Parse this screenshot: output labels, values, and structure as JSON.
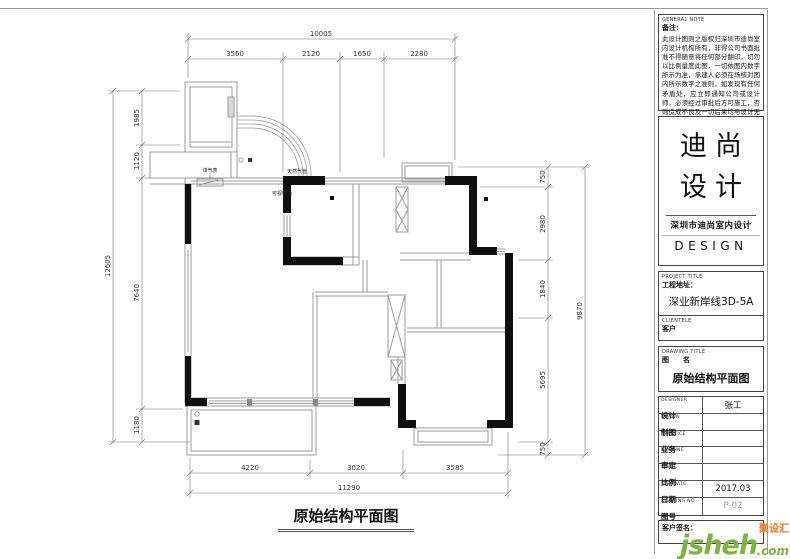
{
  "plan": {
    "title": "原始结构平面图",
    "labels": {
      "gas_meter": "煤气表",
      "gas_pipe": "天然气管",
      "intercom": "可视电话"
    },
    "dims": {
      "top": {
        "overall": "10005",
        "segs": [
          "3560",
          "2120",
          "1650",
          "2280"
        ]
      },
      "left": {
        "overall": "12605",
        "segs": [
          "1985",
          "1120",
          "7640",
          "1180"
        ]
      },
      "right": {
        "overall": "9870",
        "segs": [
          "750",
          "2980",
          "1840",
          "5695",
          "750"
        ]
      },
      "bottom": {
        "overall": "11290",
        "segs": [
          "4220",
          "3020",
          "3585"
        ]
      }
    }
  },
  "title_block": {
    "general_note": {
      "label_en": "GENERAL NOTE",
      "label_cn": "备注:",
      "text": "此设计图则之版权归深圳市迪尚室内设计机构所有，非得公司书面批准不得随意将任何部分翻印，切勿以比例量度此图，一切依图内数字所示为准，承建人必须在场核对图内所示数字之准则，如发现有任何矛盾处，应立即通知公司或设计师，必须经过审批后方可施工，否则造成不良及一切后果均与设计无关。"
    },
    "logo": {
      "line1": "迪尚",
      "line2": "设计",
      "subtitle": "深圳市迪尚室内设计",
      "en": "DESIGN"
    },
    "project": {
      "label_en": "PROJECT TITLE",
      "label_cn": "工程地址：",
      "value": "深业新岸线3D-5A"
    },
    "clientele": {
      "label_en": "CLIENTELE",
      "label_cn": "客户",
      "value": ""
    },
    "drawing_title": {
      "label_en": "DRAWING TITLE",
      "label_cn": "图　　名",
      "value": "原始结构平面图"
    },
    "rows": [
      {
        "en": "DESIGNER",
        "cn": "设计",
        "value": "张工"
      },
      {
        "en": "DRAWN",
        "cn": "制图",
        "value": ""
      },
      {
        "en": "PRACTICE",
        "cn": "业务",
        "value": ""
      },
      {
        "en": "EXAMINE",
        "cn": "审定",
        "value": ""
      },
      {
        "en": "SCALE",
        "cn": "比例",
        "value": ""
      },
      {
        "en": "SIG. DATE",
        "cn": "日期",
        "value": "2017.03"
      },
      {
        "en": "DRAWING NO",
        "cn": "图号",
        "value": "P-02"
      }
    ],
    "signature": {
      "label": "客户签名："
    }
  },
  "watermark": {
    "name": "jsheh",
    "tld": ".com",
    "badge": "聚设汇",
    "green": "#7cb342",
    "orange": "#f7761d"
  }
}
